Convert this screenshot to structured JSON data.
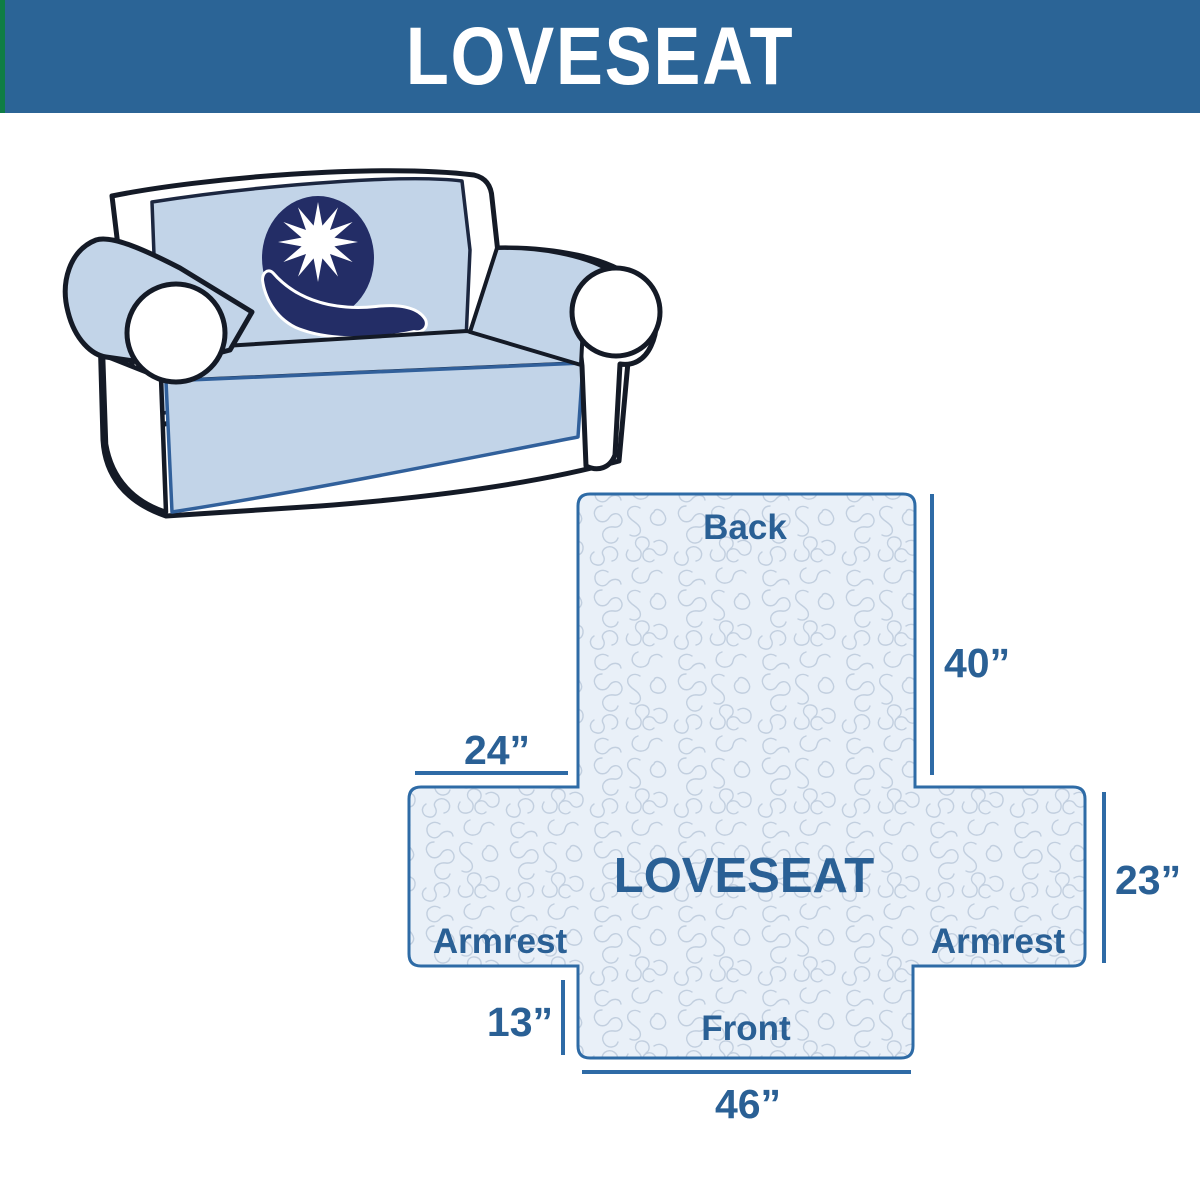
{
  "header": {
    "title": "LOVESEAT",
    "bg_color": "#2b6496",
    "accent_color": "#0f7d45",
    "text_color": "#ffffff"
  },
  "sofa": {
    "logo_icon": "q-star-logo",
    "cover_color": "#c2d4e8",
    "logo_color": "#232d66",
    "outline_color": "#141a26"
  },
  "diagram": {
    "center_label": "LOVESEAT",
    "back_label": "Back",
    "front_label": "Front",
    "armrest_left_label": "Armrest",
    "armrest_right_label": "Armrest",
    "dim_back_height": "40”",
    "dim_armrest_top_width": "24”",
    "dim_armrest_side_height": "23”",
    "dim_front_side_height": "13”",
    "dim_front_width": "46”",
    "outline_color": "#2e6ba6",
    "fill_color": "#e9f0f8",
    "pattern_color": "#c2cfdf",
    "text_color": "#2a6095"
  }
}
